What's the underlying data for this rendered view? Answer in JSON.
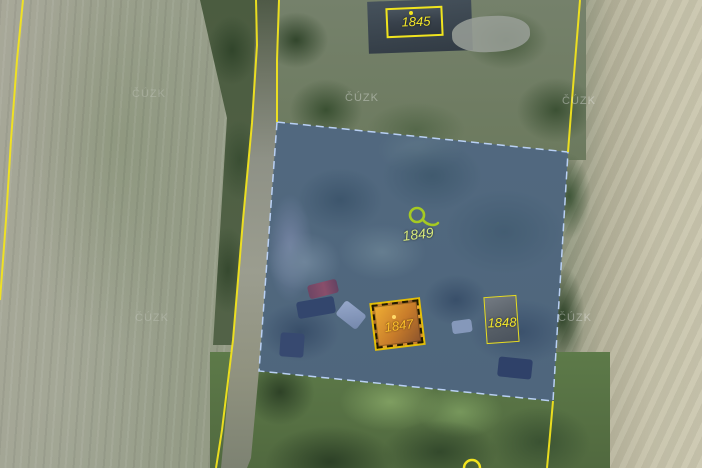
{
  "map": {
    "watermark_text": "ČÚZK",
    "parcel_labels": {
      "p1845": "1845",
      "p1849": "1849",
      "p1847": "1847",
      "p1848": "1848"
    },
    "colors": {
      "boundary_yellow": "#f2e41e",
      "selected_parcel_fill": "rgba(70,105,185,0.45)",
      "selected_parcel_border": "#b9d0f4",
      "building_highlight_orange": "#ff9f1e",
      "building_outline_yellow": "#e8dc20",
      "label_yellow": "#f5e82a",
      "label_orange": "#ffc02a",
      "label_green": "#d6e87c",
      "landuse_symbol_green": "#a6ca22",
      "watermark_gray": "rgba(235,235,235,0.40)"
    }
  }
}
